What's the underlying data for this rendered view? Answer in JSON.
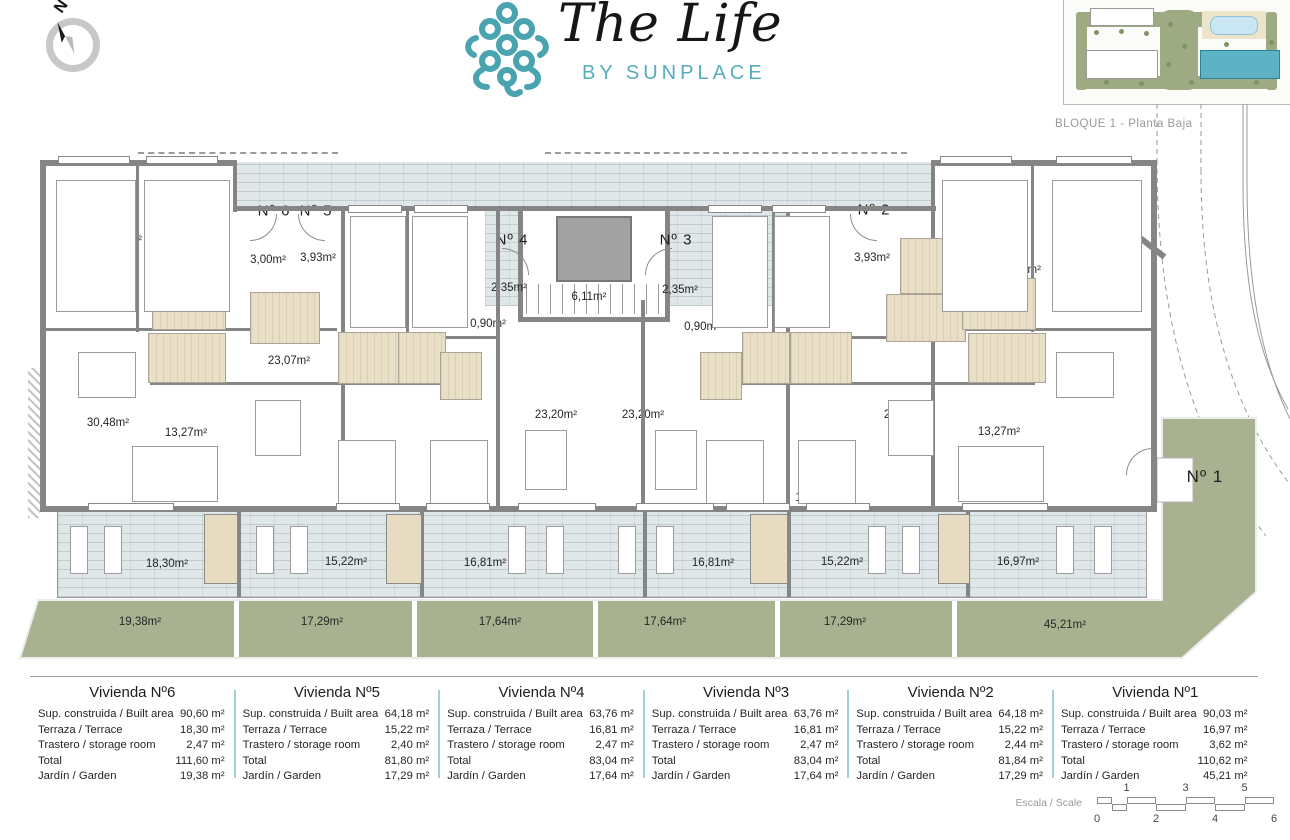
{
  "header": {
    "compass_label": "N",
    "logo": {
      "title": "The Life",
      "subtitle": "BY SUNPLACE"
    },
    "siteplan_caption": "BLOQUE 1 - Planta Baja"
  },
  "colors": {
    "accent_teal": "#56aebc",
    "walkway_terrace": "#dfe7e9",
    "garden_green": "#a9b290",
    "bathroom_floor": "#e9dfc6",
    "wall_gray": "#858585",
    "table_divider_teal": "#9fd0d6"
  },
  "plan": {
    "unit_labels": [
      {
        "text": "Nº 6",
        "x": 274,
        "y": 211
      },
      {
        "text": "Nº 5",
        "x": 316,
        "y": 211
      },
      {
        "text": "Nº 4",
        "x": 512,
        "y": 240
      },
      {
        "text": "Nº 3",
        "x": 676,
        "y": 240
      },
      {
        "text": "Nº 2",
        "x": 874,
        "y": 210
      },
      {
        "text": "Nº 1",
        "x": 1205,
        "y": 477,
        "large": true
      }
    ],
    "room_labels": [
      {
        "text": "9,14m²",
        "x": 124,
        "y": 240
      },
      {
        "text": "9,05m²",
        "x": 178,
        "y": 240
      },
      {
        "text": "3,06m²",
        "x": 186,
        "y": 273
      },
      {
        "text": "3,00m²",
        "x": 268,
        "y": 260
      },
      {
        "text": "3,93m²",
        "x": 318,
        "y": 258
      },
      {
        "text": "3,38m²",
        "x": 197,
        "y": 298
      },
      {
        "text": "3,00m²",
        "x": 285,
        "y": 315
      },
      {
        "text": "2,86m²",
        "x": 188,
        "y": 357
      },
      {
        "text": "23,07m²",
        "x": 289,
        "y": 361
      },
      {
        "text": "8,72m²",
        "x": 371,
        "y": 263
      },
      {
        "text": "8,55m²",
        "x": 448,
        "y": 263
      },
      {
        "text": "3,67m²",
        "x": 364,
        "y": 357
      },
      {
        "text": "3,37m²",
        "x": 418,
        "y": 359
      },
      {
        "text": "2,64m²",
        "x": 463,
        "y": 376
      },
      {
        "text": "2,35m²",
        "x": 509,
        "y": 288
      },
      {
        "text": "0,90m²",
        "x": 488,
        "y": 324
      },
      {
        "text": "6,11m²",
        "x": 589,
        "y": 297
      },
      {
        "text": "2,35m²",
        "x": 680,
        "y": 290
      },
      {
        "text": "0,90m²",
        "x": 702,
        "y": 327
      },
      {
        "text": "8,55m²",
        "x": 748,
        "y": 303
      },
      {
        "text": "8,72m²",
        "x": 806,
        "y": 303
      },
      {
        "text": "2,64m²",
        "x": 724,
        "y": 371
      },
      {
        "text": "3,37m²",
        "x": 770,
        "y": 357
      },
      {
        "text": "3,67m²",
        "x": 828,
        "y": 357
      },
      {
        "text": "3,93m²",
        "x": 872,
        "y": 258
      },
      {
        "text": "3,70m²",
        "x": 934,
        "y": 267
      },
      {
        "text": "4,68m²",
        "x": 921,
        "y": 313
      },
      {
        "text": "9,05m²",
        "x": 972,
        "y": 236
      },
      {
        "text": "9,14m²",
        "x": 1098,
        "y": 236
      },
      {
        "text": "2,34m²",
        "x": 1023,
        "y": 270
      },
      {
        "text": "3,38m²",
        "x": 990,
        "y": 298
      },
      {
        "text": "2,86m²",
        "x": 1002,
        "y": 357
      },
      {
        "text": "30,48m²",
        "x": 108,
        "y": 423
      },
      {
        "text": "13,27m²",
        "x": 186,
        "y": 433
      },
      {
        "text": "11,41m²",
        "x": 366,
        "y": 495
      },
      {
        "text": "11,40m²",
        "x": 456,
        "y": 493
      },
      {
        "text": "23,20m²",
        "x": 556,
        "y": 415
      },
      {
        "text": "23,20m²",
        "x": 643,
        "y": 415
      },
      {
        "text": "11,40m²",
        "x": 733,
        "y": 498
      },
      {
        "text": "11,41m²",
        "x": 816,
        "y": 498
      },
      {
        "text": "23,07m²",
        "x": 905,
        "y": 415
      },
      {
        "text": "13,27m²",
        "x": 999,
        "y": 432
      },
      {
        "text": "30,48m²",
        "x": 1093,
        "y": 388
      }
    ],
    "terrace_labels": [
      {
        "text": "18,30m²",
        "x": 167,
        "y": 564
      },
      {
        "text": "15,22m²",
        "x": 346,
        "y": 562
      },
      {
        "text": "16,81m²",
        "x": 485,
        "y": 563
      },
      {
        "text": "16,81m²",
        "x": 713,
        "y": 563
      },
      {
        "text": "15,22m²",
        "x": 842,
        "y": 562
      },
      {
        "text": "16,97m²",
        "x": 1018,
        "y": 562
      }
    ],
    "garden_labels": [
      {
        "text": "19,38m²",
        "x": 140,
        "y": 622
      },
      {
        "text": "17,29m²",
        "x": 322,
        "y": 622
      },
      {
        "text": "17,64m²",
        "x": 500,
        "y": 622
      },
      {
        "text": "17,64m²",
        "x": 665,
        "y": 622
      },
      {
        "text": "17,29m²",
        "x": 845,
        "y": 622
      },
      {
        "text": "45,21m²",
        "x": 1065,
        "y": 625
      }
    ]
  },
  "summary": {
    "row_labels": [
      "Sup. construida / Built area",
      "Terraza / Terrace",
      "Trastero / storage room",
      "Total",
      "Jardín / Garden"
    ],
    "units": [
      {
        "title": "Vivienda Nº6",
        "values": [
          "90,60 m²",
          "18,30 m²",
          "2,47 m²",
          "111,60 m²",
          "19,38 m²"
        ]
      },
      {
        "title": "Vivienda Nº5",
        "values": [
          "64,18 m²",
          "15,22 m²",
          "2,40 m²",
          "81,80 m²",
          "17,29 m²"
        ]
      },
      {
        "title": "Vivienda Nº4",
        "values": [
          "63,76 m²",
          "16,81 m²",
          "2,47 m²",
          "83,04 m²",
          "17,64 m²"
        ]
      },
      {
        "title": "Vivienda Nº3",
        "values": [
          "63,76 m²",
          "16,81 m²",
          "2,47 m²",
          "83,04 m²",
          "17,64 m²"
        ]
      },
      {
        "title": "Vivienda Nº2",
        "values": [
          "64,18 m²",
          "15,22 m²",
          "2,44 m²",
          "81,84 m²",
          "17,29 m²"
        ]
      },
      {
        "title": "Vivienda Nº1",
        "values": [
          "90,03 m²",
          "16,97 m²",
          "3,62 m²",
          "110,62 m²",
          "45,21 m²"
        ]
      }
    ]
  },
  "scale_bar": {
    "label": "Escala / Scale",
    "top_ticks": [
      "1",
      "3",
      "5"
    ],
    "bottom_ticks": [
      "0",
      "2",
      "4",
      "6"
    ]
  }
}
